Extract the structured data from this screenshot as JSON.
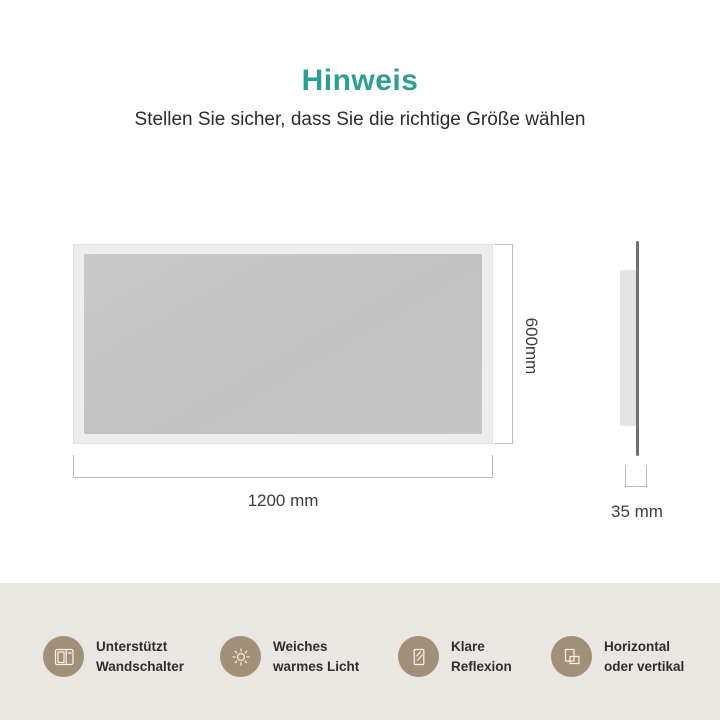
{
  "header": {
    "title": "Hinweis",
    "subtitle": "Stellen Sie sicher, dass Sie die richtige Größe wählen",
    "title_color": "#2f9d94"
  },
  "diagram": {
    "front_view": {
      "width_label": "1200 mm",
      "height_label": "600mm"
    },
    "side_view": {
      "depth_label": "35 mm"
    }
  },
  "features": [
    {
      "icon": "wall-switch-icon",
      "line1": "Unterstützt",
      "line2": "Wandschalter"
    },
    {
      "icon": "sun-icon",
      "line1": "Weiches",
      "line2": "warmes Licht"
    },
    {
      "icon": "mirror-reflection-icon",
      "line1": "Klare",
      "line2": "Reflexion"
    },
    {
      "icon": "orientation-icon",
      "line1": "Horizontal",
      "line2": "oder vertikal"
    }
  ],
  "colors": {
    "accent_teal": "#2f9d94",
    "band_background": "#eae6e1",
    "feature_circle": "#a28f7a",
    "mirror_frame": "#ededed",
    "mirror_glass": "#c4c4c4",
    "dimension_line": "#bdbdbd",
    "text_dark": "#2e2e2e"
  }
}
